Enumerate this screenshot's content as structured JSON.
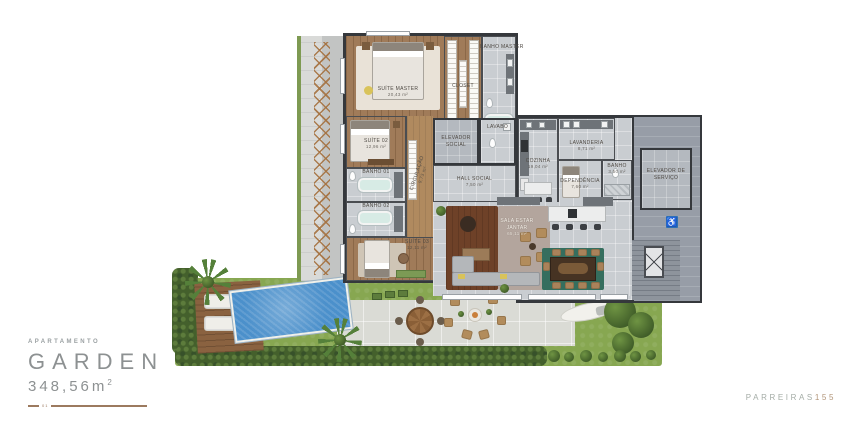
{
  "title_block": {
    "category": "APARTAMENTO",
    "name": "GARDEN",
    "area": "348,56m",
    "area_sup": "2",
    "unit_marker": "01"
  },
  "brand": {
    "name": "PARREIRAS",
    "number": "155"
  },
  "rooms": {
    "suite_master": {
      "name": "SUÍTE MASTER",
      "area": "20,43 m²"
    },
    "closet": {
      "name": "CLOSET"
    },
    "banho_master": {
      "name": "BANHO MASTER"
    },
    "suite_02": {
      "name": "SUÍTE 02",
      "area": "12,96 m²"
    },
    "banho_01": {
      "name": "BANHO 01"
    },
    "banho_02": {
      "name": "BANHO 02"
    },
    "circulacao": {
      "name": "CIRCULAÇÃO",
      "area": "9,73 m²"
    },
    "suite_03": {
      "name": "SUÍTE 03",
      "area": "12,11 m²"
    },
    "elevador_social": {
      "name": "ELEVADOR SOCIAL"
    },
    "lavabo": {
      "name": "LAVABO"
    },
    "hall_social": {
      "name": "HALL SOCIAL",
      "area": "7,50 m²"
    },
    "cozinha": {
      "name": "COZINHA",
      "area": "19,04 m²"
    },
    "lavanderia": {
      "name": "LAVANDERIA",
      "area": "8,71 m²"
    },
    "dependencia": {
      "name": "DEPENDÊNCIA",
      "area": "7,60 m²"
    },
    "banho_servico": {
      "name": "BANHO",
      "area": "3,50 m²"
    },
    "elevador_servico": {
      "name": "ELEVADOR DE SERVIÇO"
    },
    "sala": {
      "name": "SALA ESTAR JANTAR",
      "area": "65,11 m²"
    }
  },
  "icons": {
    "accessibility": "♿"
  },
  "colors": {
    "accent_brown": "#9C7A5F",
    "brand_gray": "#A4ACA6",
    "brand_number": "#B29579",
    "wall": "#35383C",
    "pool_blue": "#4B90CB",
    "grass_green": "#87A751"
  }
}
